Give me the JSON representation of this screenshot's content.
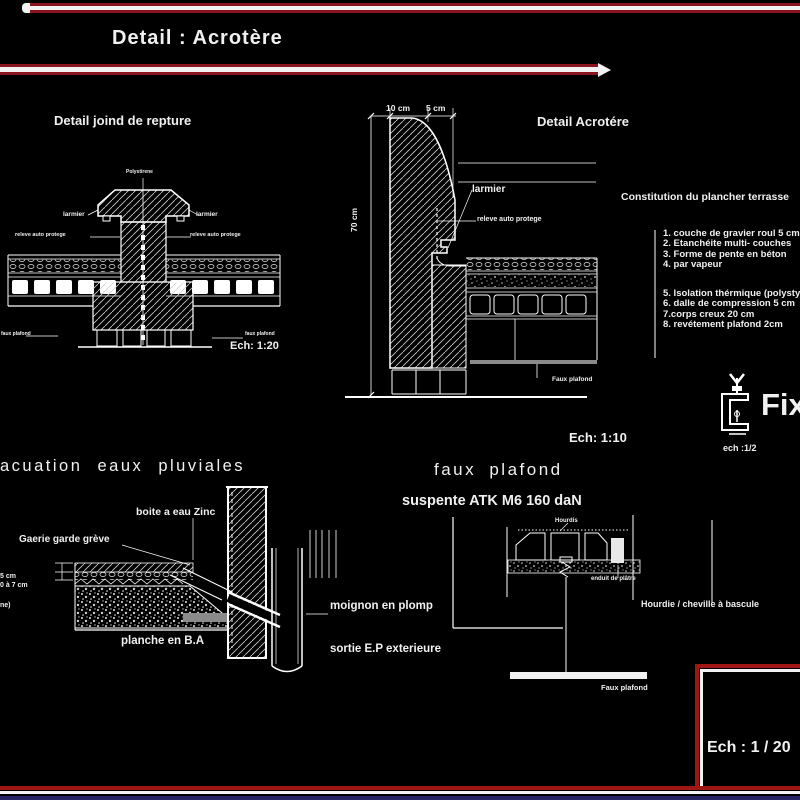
{
  "page": {
    "title": "Detail  : Acrotère",
    "scale_box": "Ech : 1 / 20"
  },
  "joint_detail": {
    "title": "Detail   joind de repture",
    "top_label": "Polystirene",
    "larmier_left": "larmier",
    "larmier_right": "larmier",
    "releve_left": "releve auto protege",
    "releve_right": "releve auto protege",
    "bottom_left": "faux plafond",
    "bottom_right": "faux plafond",
    "scale": "Ech: 1:20"
  },
  "acrotere_detail": {
    "title": "Detail   Acrotére",
    "dim_top_1": "10 cm",
    "dim_top_2": "5 cm",
    "dim_left": "70 cm",
    "larmier": "larmier",
    "releve": "releve auto protege",
    "faux_plafond": "Faux plafond",
    "scale": "Ech: 1:10",
    "constitution_title": "Constitution du  plancher terrasse",
    "layers": [
      "1. couche de gravier roul 5 cm",
      "2. Etanchéite multi- couches",
      "3. Forme de pente en béton ",
      "4. par vapeur"
    ],
    "layers2": [
      "5. Isolation thérmique (polystyrène)",
      "6. dalle de compression 5 cm",
      "7.corps creux 20 cm",
      "8. revétement plafond  2cm"
    ]
  },
  "fixation": {
    "label": "Fix",
    "scale": "ech :1/2"
  },
  "evacuation": {
    "title": "acuation  eaux   pluviales",
    "boite": "boite a eau Zinc",
    "garde_greve": "Gaerie garde grève",
    "planche": "planche en B.A",
    "dim1": "5 cm",
    "dim2": "0 à 7 cm",
    "dim3": "ne)",
    "moignon": "moignon en plomp",
    "sortie": "sortie E.P exterieure"
  },
  "faux_plafond_detail": {
    "title": "faux  plafond",
    "suspente": "suspente   ATK M6  160 daN",
    "hourdis_small": "Hourdis",
    "enduit": "enduit de plâtre",
    "hourdie": "Hourdie / cheville à bascule",
    "faux_plafond_label": "Faux plafond"
  },
  "colors": {
    "bar_red": "#8a1520",
    "frame_red": "#a01515",
    "navy": "#262563",
    "gray": "#8a8a8a"
  }
}
